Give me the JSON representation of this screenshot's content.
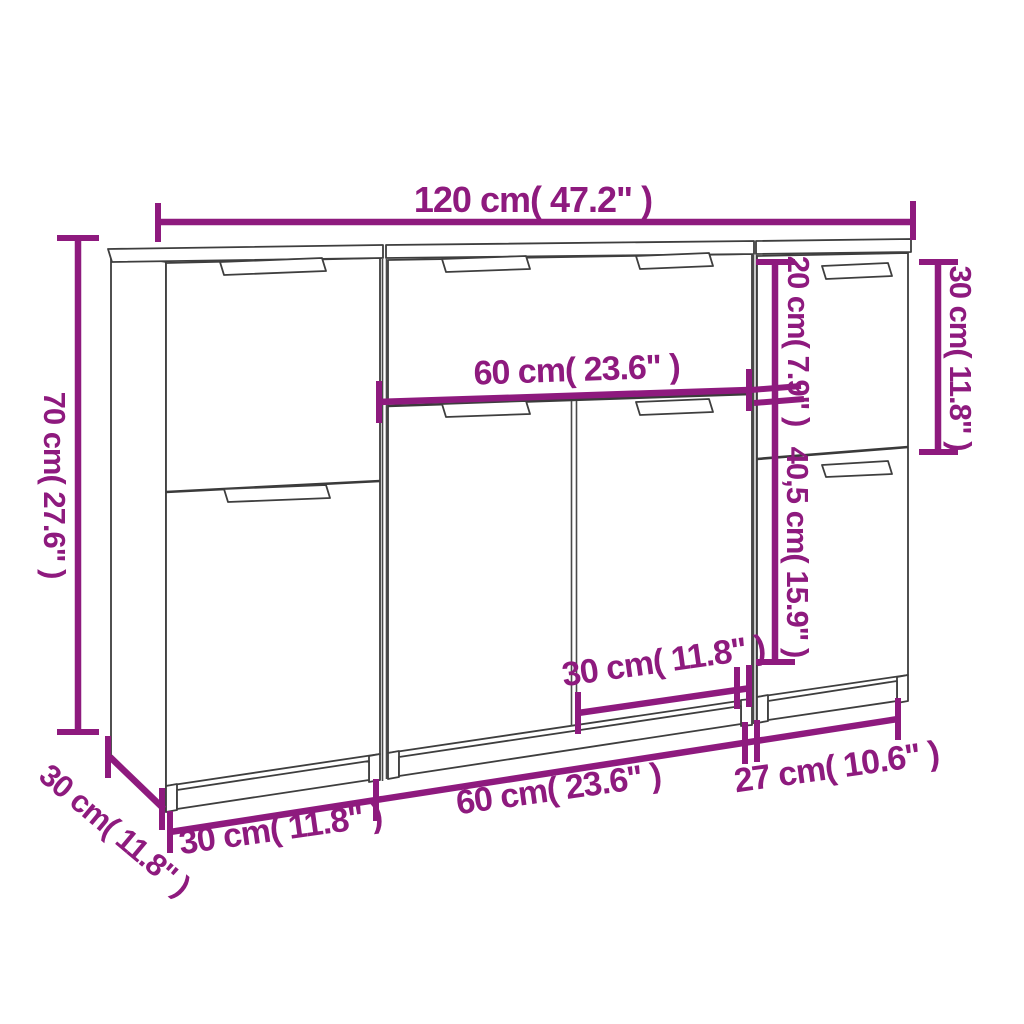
{
  "diagram": {
    "background": "#ffffff",
    "accent_color": "#8E1A7E",
    "outline_color": "#3e3e3e",
    "subject": "three-piece sideboard dimension drawing",
    "labels": {
      "total_width": "120 cm( 47.2\" )",
      "total_height": "70 cm( 27.6\" )",
      "depth": "30 cm( 11.8\" )",
      "middle_cabinet_width": "60 cm( 23.6\" )",
      "right_drawer_height": "20 cm( 7.9\" )",
      "right_top_section_height": "30 cm( 11.8\" )",
      "right_door_height": "40,5 cm( 15.9\" )",
      "middle_right_door_width": "30 cm( 11.8\" )",
      "left_cabinet_width": "30 cm( 11.8\" )",
      "middle_cabinet_bottom_width": "60 cm( 23.6\" )",
      "right_cabinet_width": "27 cm( 10.6\" )"
    }
  }
}
